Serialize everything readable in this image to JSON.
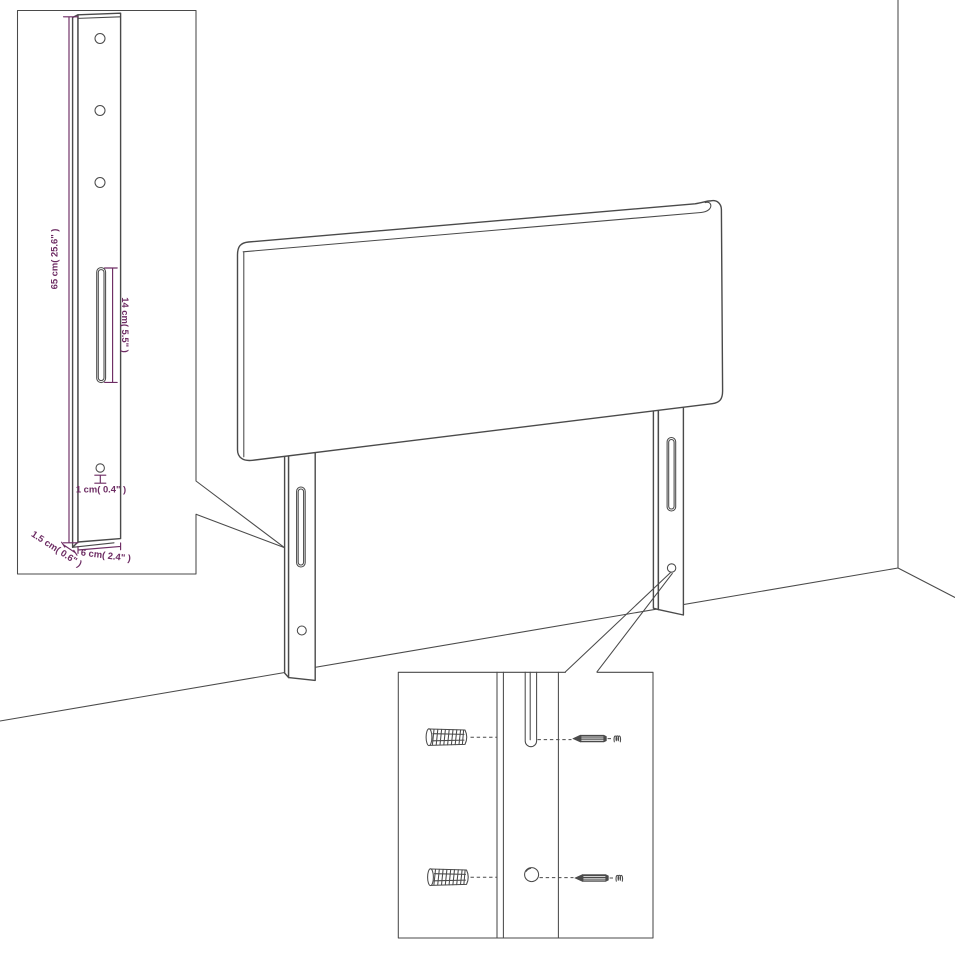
{
  "diagram": {
    "type": "furniture-assembly-dimension-diagram",
    "subject": "upholstered headboard with two mounting legs shown in a room corner",
    "colors": {
      "background": "#ffffff",
      "line_art": "#4a4a4a",
      "dimension_accent": "#6d2c63"
    },
    "insets": {
      "leg_dimensions": {
        "description": "enlarged side leg with three drill holes, long slot and small hole",
        "dims": {
          "leg_height": "65 cm( 25.6\" )",
          "slot_length": "14 cm( 5.5\" )",
          "hole_diameter": "1 cm( 0.4\" )",
          "leg_depth": "1.5 cm( 0.6\" )",
          "leg_width": "6 cm( 2.4\" )"
        }
      },
      "mounting_detail": {
        "description": "close-up of leg slot and screw hole with wall plugs and screws",
        "hardware": [
          "wall-plug",
          "wall-plug",
          "screw",
          "screw"
        ]
      }
    }
  }
}
